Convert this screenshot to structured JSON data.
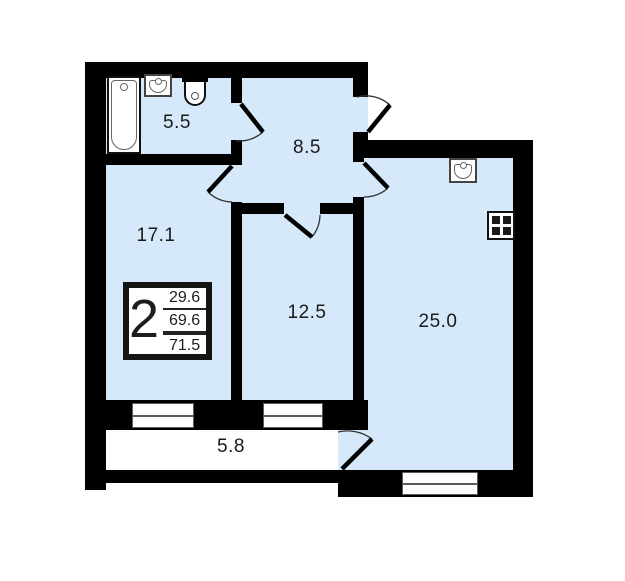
{
  "plan": {
    "type": "apartment-floor-plan",
    "info_box": {
      "room_count": "2",
      "living_area": "29.6",
      "area_without_balcony": "69.6",
      "total_area": "71.5"
    },
    "rooms": {
      "bathroom": {
        "area": "5.5"
      },
      "hallway": {
        "area": "8.5"
      },
      "living_room": {
        "area": "17.1"
      },
      "bedroom": {
        "area": "12.5"
      },
      "kitchen_living": {
        "area": "25.0"
      },
      "balcony": {
        "area": "5.8"
      }
    },
    "icons": [
      "bathtub-icon",
      "bathroom-sink-icon",
      "toilet-icon",
      "kitchen-sink-icon",
      "stove-icon",
      "window",
      "door-swing"
    ],
    "colors": {
      "room_fill": "#d6e9fa",
      "wall": "#000000",
      "balcony_fill": "#ffffff",
      "text": "#1a1a1a"
    }
  }
}
